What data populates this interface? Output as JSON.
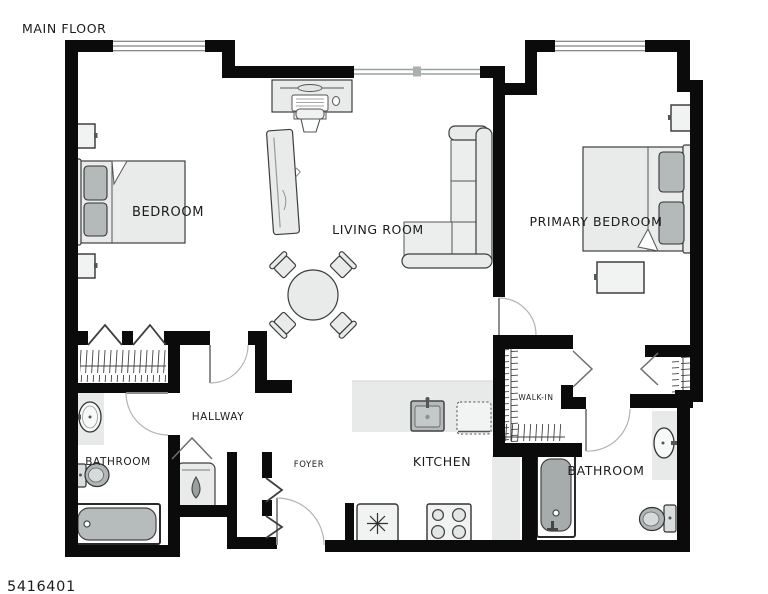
{
  "floor_plan": {
    "floor_label": "MAIN FLOOR",
    "plan_number": "5416401",
    "rooms": [
      {
        "id": "bedroom",
        "label": "BEDROOM"
      },
      {
        "id": "living-room",
        "label": "LIVING ROOM"
      },
      {
        "id": "primary-bedroom",
        "label": "PRIMARY BEDROOM"
      },
      {
        "id": "hallway",
        "label": "HALLWAY"
      },
      {
        "id": "bathroom-main",
        "label": "BATHROOM"
      },
      {
        "id": "foyer",
        "label": "FOYER"
      },
      {
        "id": "kitchen",
        "label": "KITCHEN"
      },
      {
        "id": "walk-in-closet",
        "label": "WALK-IN"
      },
      {
        "id": "bathroom-primary",
        "label": "BATHROOM"
      }
    ],
    "fixture_icons": [
      "bed-icon",
      "pillow-icon",
      "nightstand-icon",
      "closet-rod-hatch-icon",
      "bifold-door-icon",
      "door-swing-icon",
      "window-icon",
      "desk-icon",
      "office-chair-icon",
      "tv-console-icon",
      "dining-table-icon",
      "dining-chair-icon",
      "sectional-sofa-icon",
      "kitchen-sink-icon",
      "dishwasher-icon",
      "refrigerator-snowflake-icon",
      "stove-burners-icon",
      "bathtub-icon",
      "toilet-icon",
      "vanity-sink-icon",
      "water-heater-drop-icon"
    ],
    "colors": {
      "wall": "#0b0b0b",
      "furn": "#e9ebeb",
      "soft": "#b4baba",
      "counter": "#e8eaea",
      "ink": "#3d3d3d",
      "text": "#1c1c1c"
    }
  }
}
